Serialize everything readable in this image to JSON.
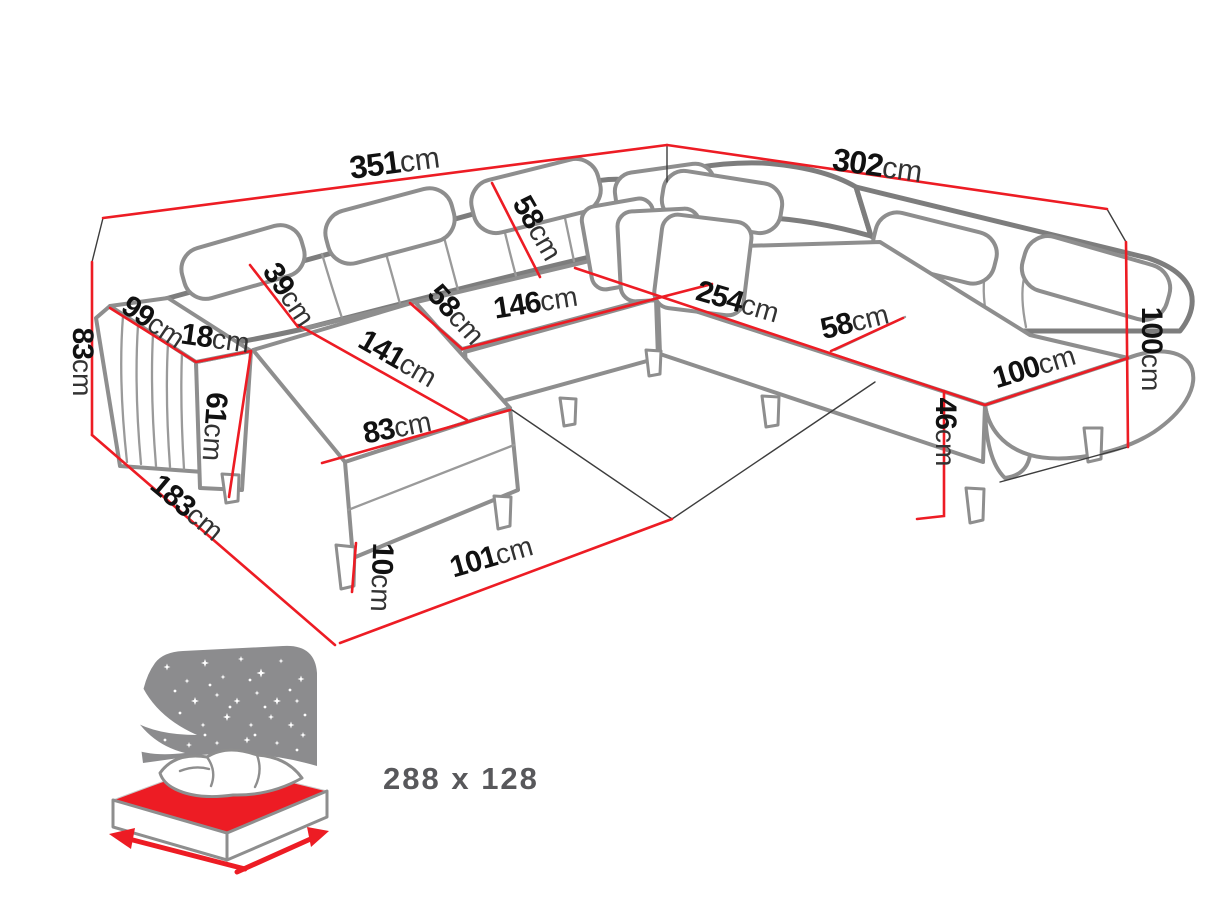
{
  "diagram_type": "corner-sofa-dimensions",
  "unit": "cm",
  "colors": {
    "dimension_red": "#ed1c24",
    "sofa_outline_gray": "#8e8e8e",
    "construction_line": "#3d3d3d",
    "label_number": "#111111",
    "label_unit": "#333333",
    "bed_icon_gray": "#8c8c8e",
    "mattress_red": "#ed1c24",
    "bed_size_text": "#58585b"
  },
  "dimensions": [
    {
      "id": "total-width-left",
      "value": "351",
      "unit": "cm"
    },
    {
      "id": "total-width-right",
      "value": "302",
      "unit": "cm"
    },
    {
      "id": "backrest-width-left",
      "value": "58",
      "unit": "cm"
    },
    {
      "id": "headrest-height",
      "value": "39",
      "unit": "cm"
    },
    {
      "id": "armrest-length",
      "value": "99",
      "unit": "cm"
    },
    {
      "id": "armrest-width",
      "value": "18",
      "unit": "cm"
    },
    {
      "id": "height-left",
      "value": "83",
      "unit": "cm"
    },
    {
      "id": "armrest-height",
      "value": "61",
      "unit": "cm"
    },
    {
      "id": "chaise-length",
      "value": "141",
      "unit": "cm"
    },
    {
      "id": "chaise-width",
      "value": "83",
      "unit": "cm"
    },
    {
      "id": "seat-depth-left",
      "value": "58",
      "unit": "cm"
    },
    {
      "id": "seat-width-left",
      "value": "146",
      "unit": "cm"
    },
    {
      "id": "seat-width-right",
      "value": "254",
      "unit": "cm"
    },
    {
      "id": "seat-depth-right",
      "value": "58",
      "unit": "cm"
    },
    {
      "id": "section-depth-right",
      "value": "100",
      "unit": "cm"
    },
    {
      "id": "total-height-right",
      "value": "100",
      "unit": "cm"
    },
    {
      "id": "seat-height",
      "value": "46",
      "unit": "cm"
    },
    {
      "id": "side-depth-left",
      "value": "183",
      "unit": "cm"
    },
    {
      "id": "leg-height",
      "value": "10",
      "unit": "cm"
    },
    {
      "id": "front-passage-width",
      "value": "101",
      "unit": "cm"
    }
  ],
  "sleeping_area": {
    "label": "288 x 128"
  }
}
